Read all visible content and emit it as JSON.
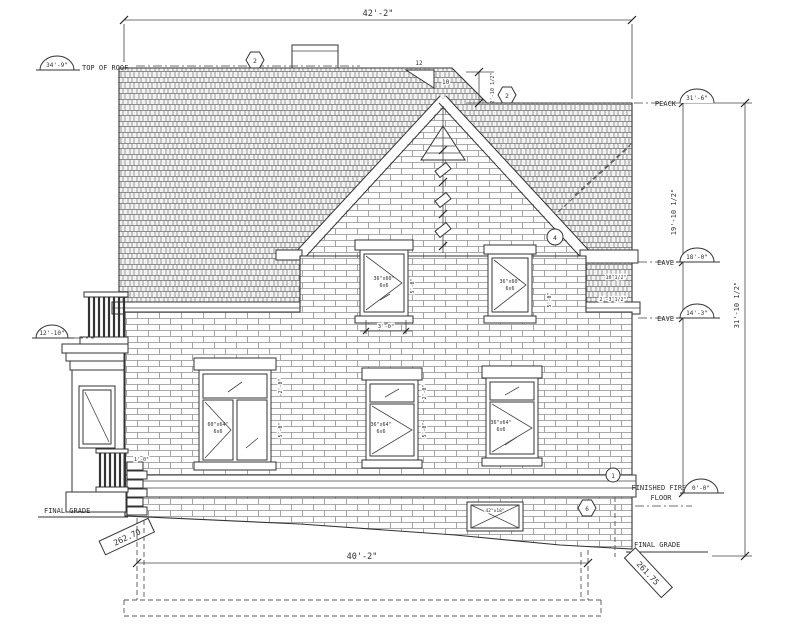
{
  "drawing": {
    "dims": {
      "top_width": "42'-2\"",
      "bottom_width": "40'-2\"",
      "roof_height_upper": "19'-10 1/2\"",
      "total_height": "31'-10 1/2\"",
      "roof_offset": "2'-10 1/2\"",
      "pitch_rise": "12",
      "pitch_run": "10",
      "upper_window_width": "3'-0\"",
      "transom_height": "2'-0\"",
      "sash_height": "5'-0\"",
      "overhang_a": "10 1/2\"",
      "overhang_b": "2'-3 1/2\"",
      "porch_step": "1'-0\""
    },
    "levels": {
      "top_of_roof_label": "TOP OF ROOF",
      "top_of_roof_value": "34'-9\"",
      "peak_label": "PEACK",
      "peak_value": "31'-6\"",
      "eave_upper_label": "EAVE",
      "eave_upper_value": "18'-0\"",
      "eave_lower_label": "EAVE",
      "eave_lower_value": "14'-3\"",
      "balcony_value": "12'-10\"",
      "first_floor_label_line1": "FINISHED FIRST",
      "first_floor_label_line2": "FLOOR",
      "first_floor_value": "0'-0\"",
      "final_grade_left_label": "FINAL GRADE",
      "final_grade_left_elev": "262.70",
      "final_grade_right_label": "FINAL GRADE",
      "final_grade_right_elev": "261.75"
    },
    "windows": {
      "upper_left": {
        "size": "36\"x60\"",
        "type": "6x6"
      },
      "upper_right": {
        "size": "36\"x60\"",
        "type": "6x6"
      },
      "lower_left": {
        "size": "60\"x64\"",
        "type": "6x6"
      },
      "lower_mid": {
        "size": "36\"x64\"",
        "type": "6x6"
      },
      "lower_right": {
        "size": "36\"x64\"",
        "type": "6x6"
      },
      "basement": {
        "size": "42\"x18\""
      }
    },
    "callouts": {
      "roof_note": "2",
      "gable_note": "2",
      "eave_note": "4",
      "floor_note": "1",
      "basement_note": "6"
    }
  }
}
